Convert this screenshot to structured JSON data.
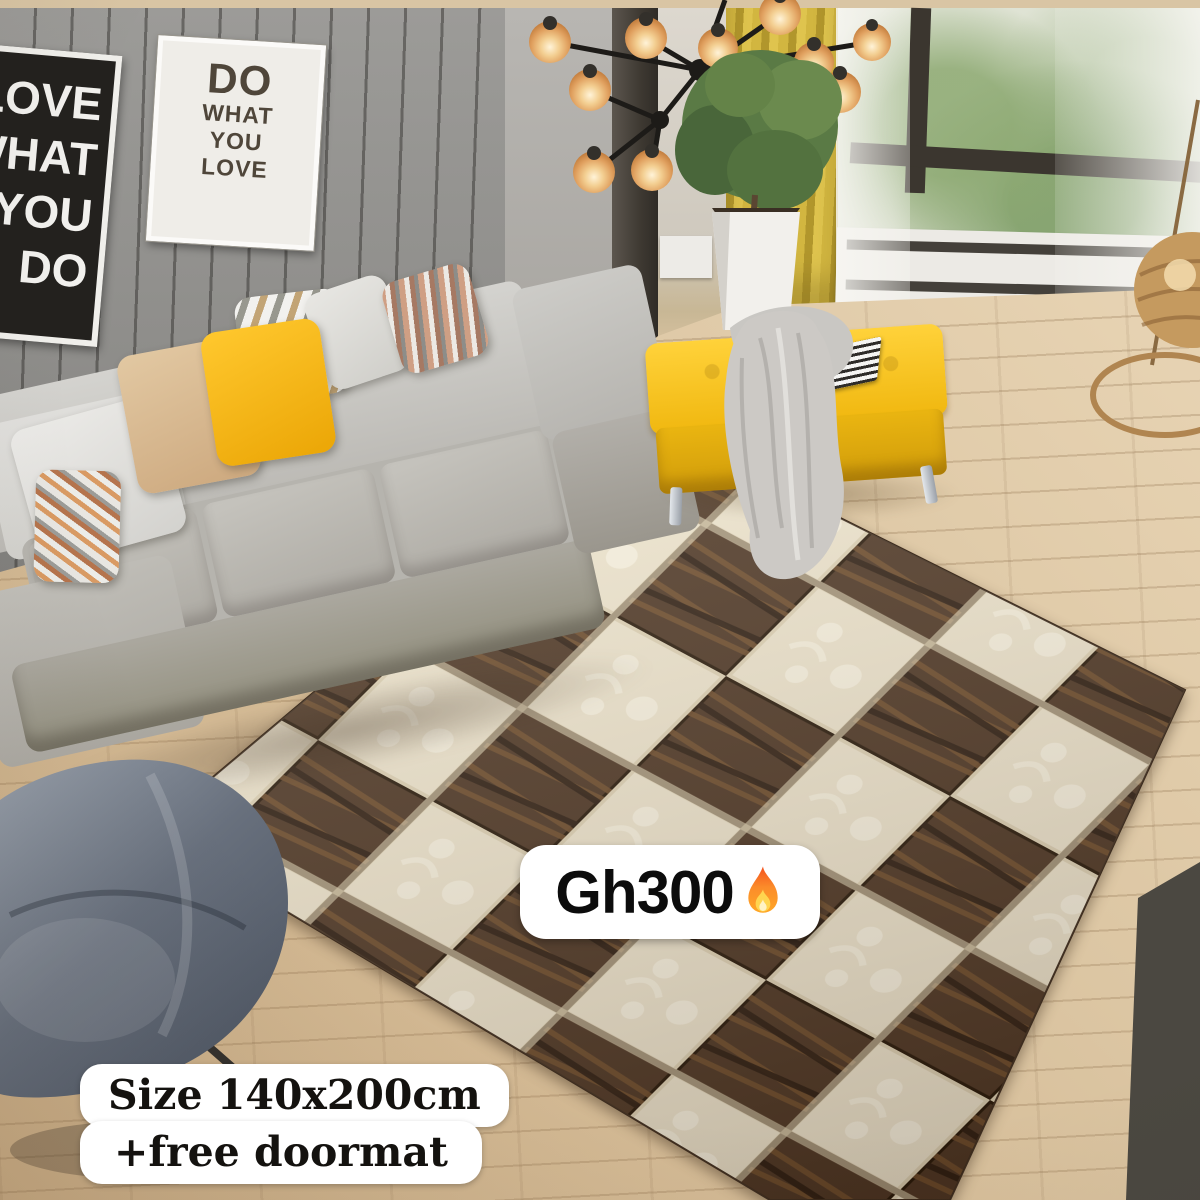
{
  "overlays": {
    "price_tag": {
      "text": "Gh300",
      "icon": "fire-emoji"
    },
    "size_label": {
      "line1": "Size 140x200cm",
      "line2": "+free doormat"
    }
  },
  "wall_art": {
    "white_poster": {
      "line1": "DO",
      "line2": "WHAT",
      "line3": "YOU",
      "line4": "LOVE"
    },
    "dark_poster": {
      "line1": "LOVE",
      "line2": "WHAT",
      "line3": "YOU",
      "line4": "DO"
    }
  },
  "scene": {
    "description_items": {
      "rug": "diamond checkerboard rug, dark brown stone-texture and cream floral tiles",
      "furniture": "gray fabric sofa, yellow tufted bench with gray throw blanket, blue-gray leather chair",
      "decor": "modern black chandelier with amber globes, potted plant, yellow curtain, window with greenery, wicker floor lamp"
    }
  },
  "colors": {
    "rug_dark_brown": "#4a3322",
    "rug_cream": "#ece3cd",
    "bench_yellow": "#f2bc16",
    "pillow_yellow": "#f3b80e",
    "curtain_yellow": "#c9ad3a",
    "sofa_gray": "#bcbab4",
    "wall_gray": "#8e8d8a",
    "floor_wood": "#dbc5a2",
    "tag_background": "#ffffff",
    "tag_text": "#0c0c0c"
  }
}
